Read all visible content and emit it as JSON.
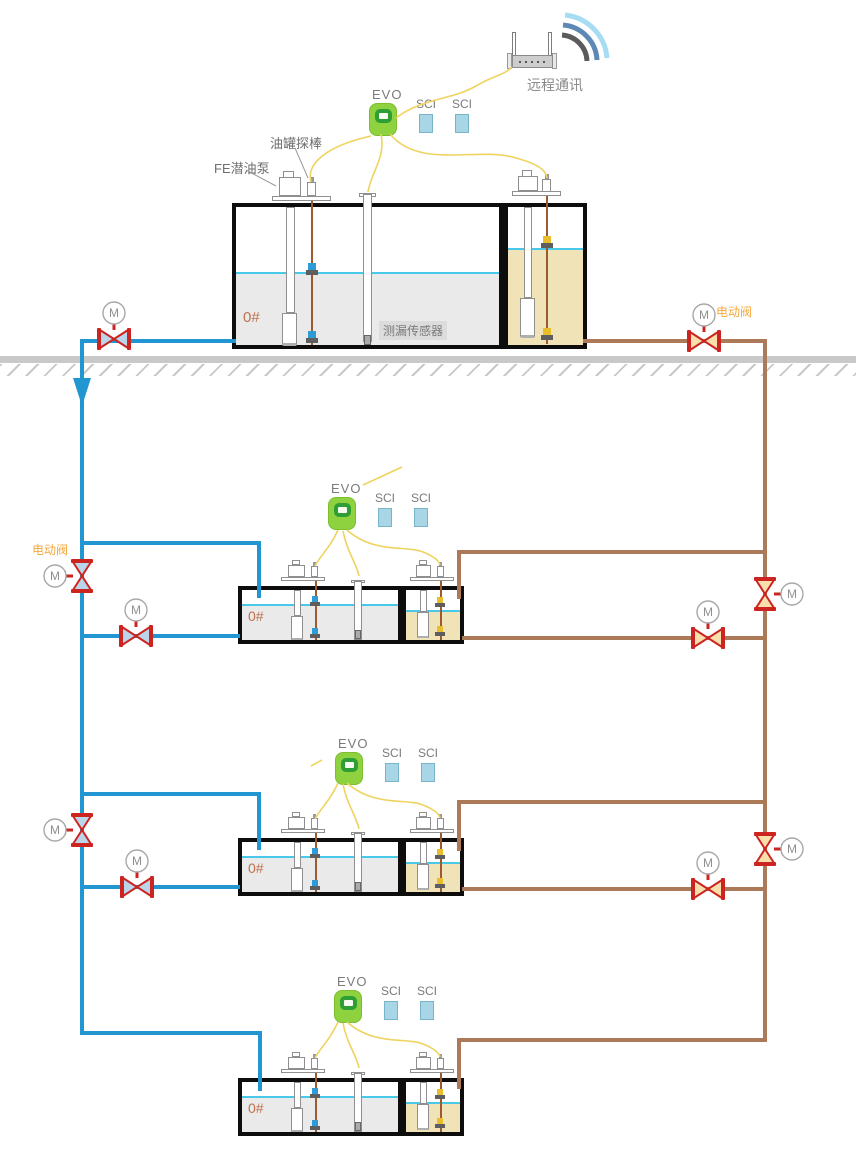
{
  "labels": {
    "evo": "EVO",
    "sci": "SCI",
    "m": "M",
    "grade": "0#",
    "remote": "远程通讯",
    "electric_valve": "电动阀",
    "leak_sensor": "测漏传感器",
    "tank_probe": "油罐探棒",
    "fe_pump": "FE潜油泵"
  },
  "colors": {
    "pipe_blue": "#2196D1",
    "pipe_brown": "#AD7A59",
    "valve_red": "#CC2420",
    "valve_fill_blue": "#BBD6EA",
    "valve_fill_tan": "#F8DFAC",
    "wire_yellow": "#EFD35F",
    "evo_green": "#8ED23F",
    "evo_ring_green": "#2E9E35",
    "sci_blue": "#A9D6E6",
    "tank_liquid_gray": "#EAEAEA",
    "tank_liquid_tan": "#F0E3B8",
    "liquid_level_cyan": "#49C9E9",
    "electric_valve_label_orange": "#F5A83C",
    "grade_orange": "#C0714C",
    "wifi_arc_outer": "#A7DDF2",
    "wifi_arc_middle": "#5F89B4",
    "wifi_arc_inner": "#5B5B5B"
  }
}
